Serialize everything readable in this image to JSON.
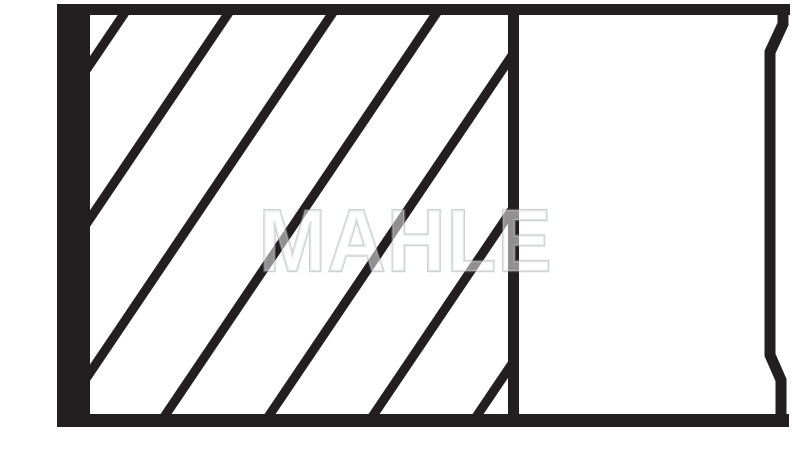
{
  "watermark": {
    "text": "MAHLE",
    "fill_color": "rgba(255,255,255,0.50)",
    "edge_color": "rgba(148,154,158,0.45)"
  },
  "colors": {
    "ink": "#231f20",
    "background": "#ffffff"
  },
  "figure": {
    "kind": "hatched cross-section line drawing",
    "hatched_region": {
      "left": 90,
      "top": 15,
      "width": 418,
      "height": 399
    },
    "hatch": {
      "angle_deg": 56,
      "top_xs": [
        123,
        227,
        331,
        435,
        539,
        643,
        747
      ],
      "start_y": 5,
      "run_px": 284,
      "drop_px": 421,
      "stroke_px": 9.2,
      "lead_px": 7
    },
    "right_edge_path": "M 783,6 L 783,24 L 770,52 L 770,355 L 781,380 L 781,424"
  }
}
